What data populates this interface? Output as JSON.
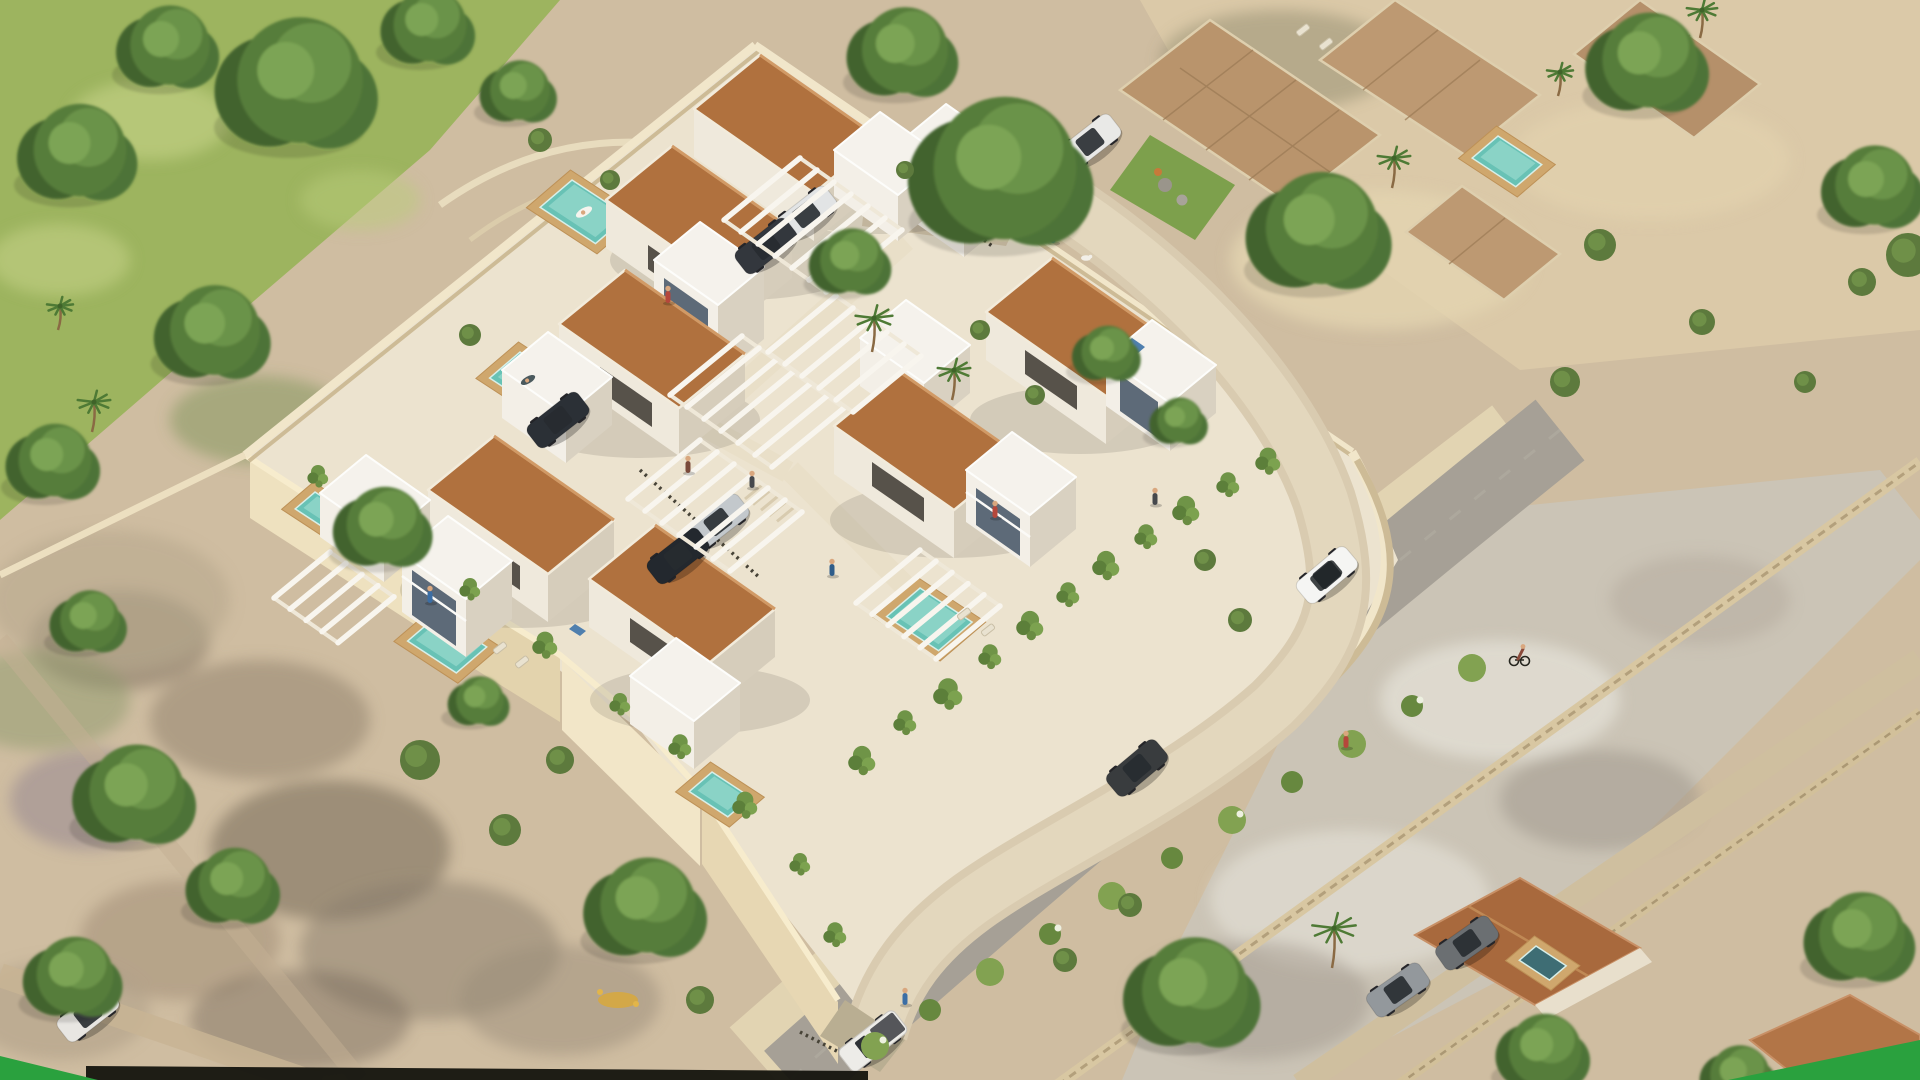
{
  "scene": {
    "title": "Aerial 3D render of a modern villa development",
    "description": "Isometric aerial architectural visualization of a walled residential complex of white modern villas with terracotta roofs, private turquoise pools, white pergola carports and a curved beige internal road, surrounded by outer roads with vehicles, existing houses, stone terraces and Mediterranean vegetation.",
    "style": "photorealistic archviz render",
    "time_of_day": "midday"
  },
  "branding": {
    "corner_accent_color": "#2aa13e",
    "corner_accent_positions": [
      "bottom-left",
      "bottom-right"
    ],
    "footer_bar_color": "#14140e"
  },
  "palette": {
    "sand": "#cfbda1",
    "site_paving": "#ece3cf",
    "wall_cream": "#f1e6ca",
    "roof_terracotta": "#b0713e",
    "villa_white": "#f3efe7",
    "villa_shadow": "#d6cdbb",
    "pool_teal": "#68c2b5",
    "deck_wood": "#cfa76d",
    "asphalt": "#a6a096",
    "vegetation_dark": "#42632e",
    "vegetation_light": "#6a9348",
    "lawn": "#9db45f"
  },
  "site": {
    "villas_terracotta_roof": 7,
    "white_annex_volumes": 10,
    "private_pools": 6,
    "pergola_carports": 6,
    "perimeter": "cream rendered walls with stepped south retaining wall",
    "internal_road": "curved beige access road with top entrance and bottom gate",
    "landscaping": "hedges, trailing vines over walls, olive trees, palms, corner lawn with boulders"
  },
  "surroundings": {
    "outer_roads": 3,
    "neighbor_houses": 2,
    "stone_terraces": 4,
    "neighbor_pools": 2,
    "moving_vehicles": [
      "white suv",
      "dark grey sedan",
      "white pickup truck"
    ],
    "cyclists": 1,
    "pedestrians": 12,
    "dogs": 1
  },
  "objects": {
    "trees": [
      [
        300,
        80,
        95
      ],
      [
        170,
        45,
        60
      ],
      [
        80,
        150,
        70
      ],
      [
        430,
        25,
        55
      ],
      [
        520,
        90,
        45
      ],
      [
        215,
        330,
        68
      ],
      [
        55,
        460,
        55
      ],
      [
        385,
        525,
        58
      ],
      [
        137,
        792,
        72
      ],
      [
        235,
        884,
        55
      ],
      [
        75,
        975,
        58
      ],
      [
        648,
        905,
        72
      ],
      [
        905,
        50,
        65
      ],
      [
        1005,
        168,
        108
      ],
      [
        852,
        260,
        48
      ],
      [
        1322,
        228,
        85
      ],
      [
        1650,
        60,
        72
      ],
      [
        1195,
        990,
        80
      ],
      [
        1862,
        935,
        65
      ],
      [
        1545,
        1050,
        55
      ],
      [
        1108,
        352,
        40
      ],
      [
        1180,
        420,
        34
      ],
      [
        480,
        700,
        36
      ],
      [
        1875,
        185,
        60
      ],
      [
        90,
        620,
        45
      ],
      [
        1740,
        1075,
        45
      ]
    ],
    "shrubs": [
      [
        1600,
        245,
        16
      ],
      [
        1702,
        322,
        13
      ],
      [
        1565,
        382,
        15
      ],
      [
        1805,
        382,
        11
      ],
      [
        1862,
        282,
        14
      ],
      [
        1240,
        620,
        12
      ],
      [
        1205,
        560,
        11
      ],
      [
        980,
        330,
        10
      ],
      [
        1035,
        395,
        10
      ],
      [
        540,
        140,
        12
      ],
      [
        610,
        180,
        10
      ],
      [
        470,
        335,
        11
      ],
      [
        700,
        1000,
        14
      ],
      [
        1130,
        905,
        12
      ],
      [
        1065,
        960,
        12
      ],
      [
        905,
        170,
        9
      ],
      [
        420,
        760,
        20
      ],
      [
        505,
        830,
        16
      ],
      [
        560,
        760,
        14
      ],
      [
        1908,
        255,
        22
      ]
    ],
    "palms": [
      [
        872,
        352,
        34
      ],
      [
        952,
        400,
        30
      ],
      [
        1332,
        968,
        40
      ],
      [
        1392,
        188,
        30
      ],
      [
        1700,
        38,
        28
      ],
      [
        92,
        432,
        30
      ],
      [
        58,
        330,
        24
      ],
      [
        1558,
        96,
        24
      ]
    ],
    "pools": [
      {
        "x": 572,
        "y": 180,
        "w": 66,
        "h": 42
      },
      {
        "x": 520,
        "y": 352,
        "w": 56,
        "h": 40
      },
      {
        "x": 438,
        "y": 615,
        "w": 58,
        "h": 40
      },
      {
        "x": 712,
        "y": 772,
        "w": 46,
        "h": 30
      },
      {
        "x": 920,
        "y": 588,
        "w": 62,
        "h": 44
      },
      {
        "x": 315,
        "y": 492,
        "w": 40,
        "h": 26
      },
      {
        "x": 1498,
        "y": 136,
        "w": 52,
        "h": 34
      },
      {
        "x": 1536,
        "y": 946,
        "w": 36,
        "h": 22,
        "dark": true
      }
    ],
    "cars": [
      {
        "x": 1327,
        "y": 575,
        "r": -40,
        "c": "#f5f5f3",
        "k": "suv"
      },
      {
        "x": 1137,
        "y": 768,
        "r": -40,
        "c": "#393c3e",
        "k": "sedan"
      },
      {
        "x": 873,
        "y": 1041,
        "r": -38,
        "c": "#edece8",
        "k": "pickup"
      },
      {
        "x": 718,
        "y": 522,
        "r": -38,
        "c": "#c3c8cc",
        "k": "sedan"
      },
      {
        "x": 678,
        "y": 556,
        "r": -38,
        "c": "#23282e",
        "k": "sedan"
      },
      {
        "x": 806,
        "y": 214,
        "r": -38,
        "c": "#e2e4e5",
        "k": "sedan"
      },
      {
        "x": 766,
        "y": 246,
        "r": -38,
        "c": "#33373d",
        "k": "sedan"
      },
      {
        "x": 1090,
        "y": 142,
        "r": -38,
        "c": "#e9e9e7",
        "k": "sedan"
      },
      {
        "x": 558,
        "y": 420,
        "r": -38,
        "c": "#2b3036",
        "k": "sedan"
      },
      {
        "x": 1467,
        "y": 943,
        "r": -35,
        "c": "#6b6f72",
        "k": "sedan"
      },
      {
        "x": 1398,
        "y": 990,
        "r": -35,
        "c": "#93989c",
        "k": "sedan"
      },
      {
        "x": 88,
        "y": 1014,
        "r": -38,
        "c": "#e8e6e2",
        "k": "sedan"
      }
    ],
    "people": [
      [
        950,
        196,
        "#b5473b"
      ],
      [
        1053,
        240,
        "#3b6ea5"
      ],
      [
        1155,
        502,
        "#45484c"
      ],
      [
        832,
        573,
        "#2f5d8a"
      ],
      [
        1005,
        148,
        "#b5473b"
      ],
      [
        668,
        300,
        "#b5473b"
      ],
      [
        752,
        485,
        "#45484c"
      ],
      [
        1346,
        745,
        "#b5473b"
      ],
      [
        688,
        470,
        "#7a4a3a"
      ],
      [
        995,
        515,
        "#b5473b"
      ],
      [
        430,
        600,
        "#3b6ea5"
      ],
      [
        905,
        1002,
        "#3b6ea5"
      ]
    ],
    "dogs": [
      [
        1086,
        258
      ]
    ],
    "cyclists": [
      [
        1520,
        655
      ]
    ],
    "vines": [
      [
        862,
        755,
        26
      ],
      [
        905,
        718,
        22
      ],
      [
        948,
        688,
        28
      ],
      [
        990,
        652,
        22
      ],
      [
        1030,
        620,
        26
      ],
      [
        1068,
        590,
        22
      ],
      [
        1106,
        560,
        26
      ],
      [
        1146,
        532,
        22
      ],
      [
        1186,
        505,
        26
      ],
      [
        1228,
        480,
        22
      ],
      [
        1268,
        456,
        24
      ],
      [
        620,
        700,
        20
      ],
      [
        545,
        640,
        24
      ],
      [
        470,
        585,
        20
      ],
      [
        395,
        528,
        22
      ],
      [
        318,
        472,
        20
      ],
      [
        680,
        742,
        22
      ],
      [
        745,
        800,
        24
      ],
      [
        800,
        860,
        20
      ],
      [
        835,
        930,
        22
      ]
    ],
    "hedge": [
      [
        875,
        1046
      ],
      [
        930,
        1010
      ],
      [
        990,
        972
      ],
      [
        1050,
        934
      ],
      [
        1112,
        896
      ],
      [
        1172,
        858
      ],
      [
        1232,
        820
      ],
      [
        1292,
        782
      ],
      [
        1352,
        744
      ],
      [
        1412,
        706
      ],
      [
        1472,
        668
      ]
    ],
    "pergolas": [
      {
        "x": 800,
        "y": 158,
        "n": 7,
        "dx": 17,
        "dy": 12,
        "sx": -76,
        "sy": 62
      },
      {
        "x": 742,
        "y": 336,
        "n": 7,
        "dx": 17,
        "dy": 12,
        "sx": -72,
        "sy": 59
      },
      {
        "x": 700,
        "y": 440,
        "n": 7,
        "dx": 17,
        "dy": 12,
        "sx": -72,
        "sy": 59
      },
      {
        "x": 836,
        "y": 296,
        "n": 6,
        "dx": 17,
        "dy": 12,
        "sx": -68,
        "sy": 56
      },
      {
        "x": 920,
        "y": 550,
        "n": 6,
        "dx": 16,
        "dy": 11.2,
        "sx": -64,
        "sy": 53
      },
      {
        "x": 330,
        "y": 552,
        "n": 5,
        "dx": 16,
        "dy": 11.2,
        "sx": -56,
        "sy": 46
      }
    ],
    "loungers": [
      [
        1303,
        30,
        -38
      ],
      [
        1326,
        44,
        -38
      ],
      [
        500,
        648,
        -38
      ],
      [
        522,
        662,
        -38
      ],
      [
        964,
        614,
        -38
      ],
      [
        988,
        630,
        -38
      ]
    ]
  }
}
